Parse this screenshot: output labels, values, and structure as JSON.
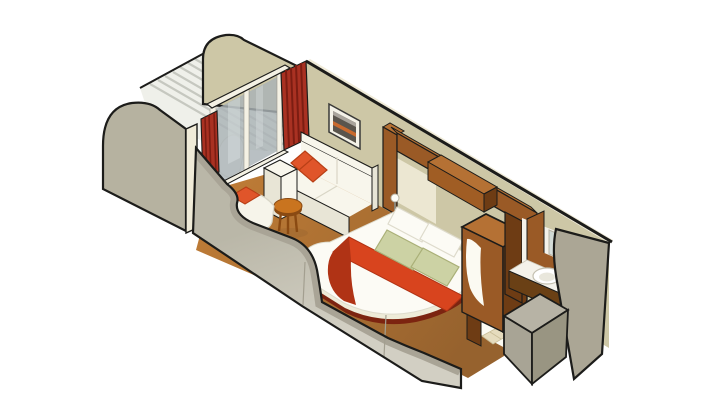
{
  "illustration": {
    "subject": "Cruise ship balcony stateroom - isometric cutaway rendering",
    "style": "3D isometric cutaway with heavy black outlines on white background",
    "areas": {
      "balcony": [
        "rounded privacy partition (far)",
        "rounded privacy partition (near)",
        "slatted deck floor",
        "balcony chair",
        "sliding glass door",
        "red curtains"
      ],
      "living_area": [
        "cream sofa",
        "orange accent pillows",
        "framed wall art",
        "round wood side table",
        "armchair with orange cushion",
        "carpet"
      ],
      "sleeping_area": [
        "bed with white duvet",
        "white pillows",
        "green accent pillows",
        "red-orange bed runner",
        "rounded bed base",
        "wood headboard surround",
        "overhead cabinet",
        "bedside lamp",
        "wardrobe"
      ],
      "entry": [
        "corridor carpet",
        "tiled entry floor",
        "open vestibule"
      ],
      "bathroom": [
        "wood vanity wall",
        "mirror",
        "wall cabinet",
        "counter with oval sink",
        "curved cutaway hull wall",
        "shower enclosure"
      ]
    }
  },
  "palette": {
    "background": "#ffffff",
    "outline": "#1c1c1a",
    "wall_khaki": "#cdc7a6",
    "cream_edge": "#f0ebd8",
    "partition_gray": "#b6b2a0",
    "slat_white": "#eff0ea",
    "slat_line": "#c6c8c0",
    "glass_blue": "#a9b2b6",
    "glass_light": "#dfe5e6",
    "frame_white": "#f4f1e4",
    "curtain_red": "#a93122",
    "curtain_red_dark": "#7c1d12",
    "carpet_light": "#bd7b36",
    "carpet_dark": "#96622e",
    "sofa_white": "#f8f6ec",
    "sofa_shade": "#e8e5d6",
    "sofa_seam": "#d9d6c6",
    "pillow_orange": "#e0552a",
    "pillow_orange_dark": "#b83f16",
    "table_wood": "#c9741f",
    "table_wood_dark": "#8a4a12",
    "wood_brown": "#9a5a26",
    "wood_brown_mid": "#a05d24",
    "wood_brown_light": "#b57134",
    "wood_brown_dark": "#6e3c14",
    "headboard_cream": "#ece7d2",
    "bed_white": "#fcfbf5",
    "bed_base_cream": "#eeebd8",
    "bed_base_maroon": "#7c2410",
    "runner_red": "#d8441e",
    "runner_red_dark": "#b03315",
    "pillow_green": "#ccd2a4",
    "pillow_green_dark": "#aab078",
    "art_frame": "#f4f2e8",
    "art_dark": "#5a554d",
    "art_orange": "#c96a2e",
    "art_sky": "#a9a49c",
    "bath_white": "#f4f2ea",
    "mirror_a": "#cfd8d4",
    "mirror_b": "#eef2ef",
    "tile_beige": "#e6dcbe",
    "tile_line": "#c9bd97",
    "cut_white": "#fbfaf2",
    "hull_top_band": "#a9a496",
    "hull_face_a": "#bab7a8",
    "hull_face_b": "#d2cfc3",
    "hull_right": "#aba695",
    "shower_top": "#b7b3a5",
    "shower_left": "#a8a495",
    "shower_right": "#999582",
    "chair_white": "#f6f4ea",
    "chair_stroke": "#d8d5c6",
    "balcony_chair_white": "#f8f8f3",
    "duvet_stroke": "#dedbcc",
    "sink_stroke": "#c4c0b0",
    "sink_inner": "#e9e7dc",
    "vanity_front": "#6a4015",
    "lamp_white": "#fdfdf8",
    "lamp_stem": "#8a8578",
    "shadow_brown": "#8a5a2a"
  }
}
